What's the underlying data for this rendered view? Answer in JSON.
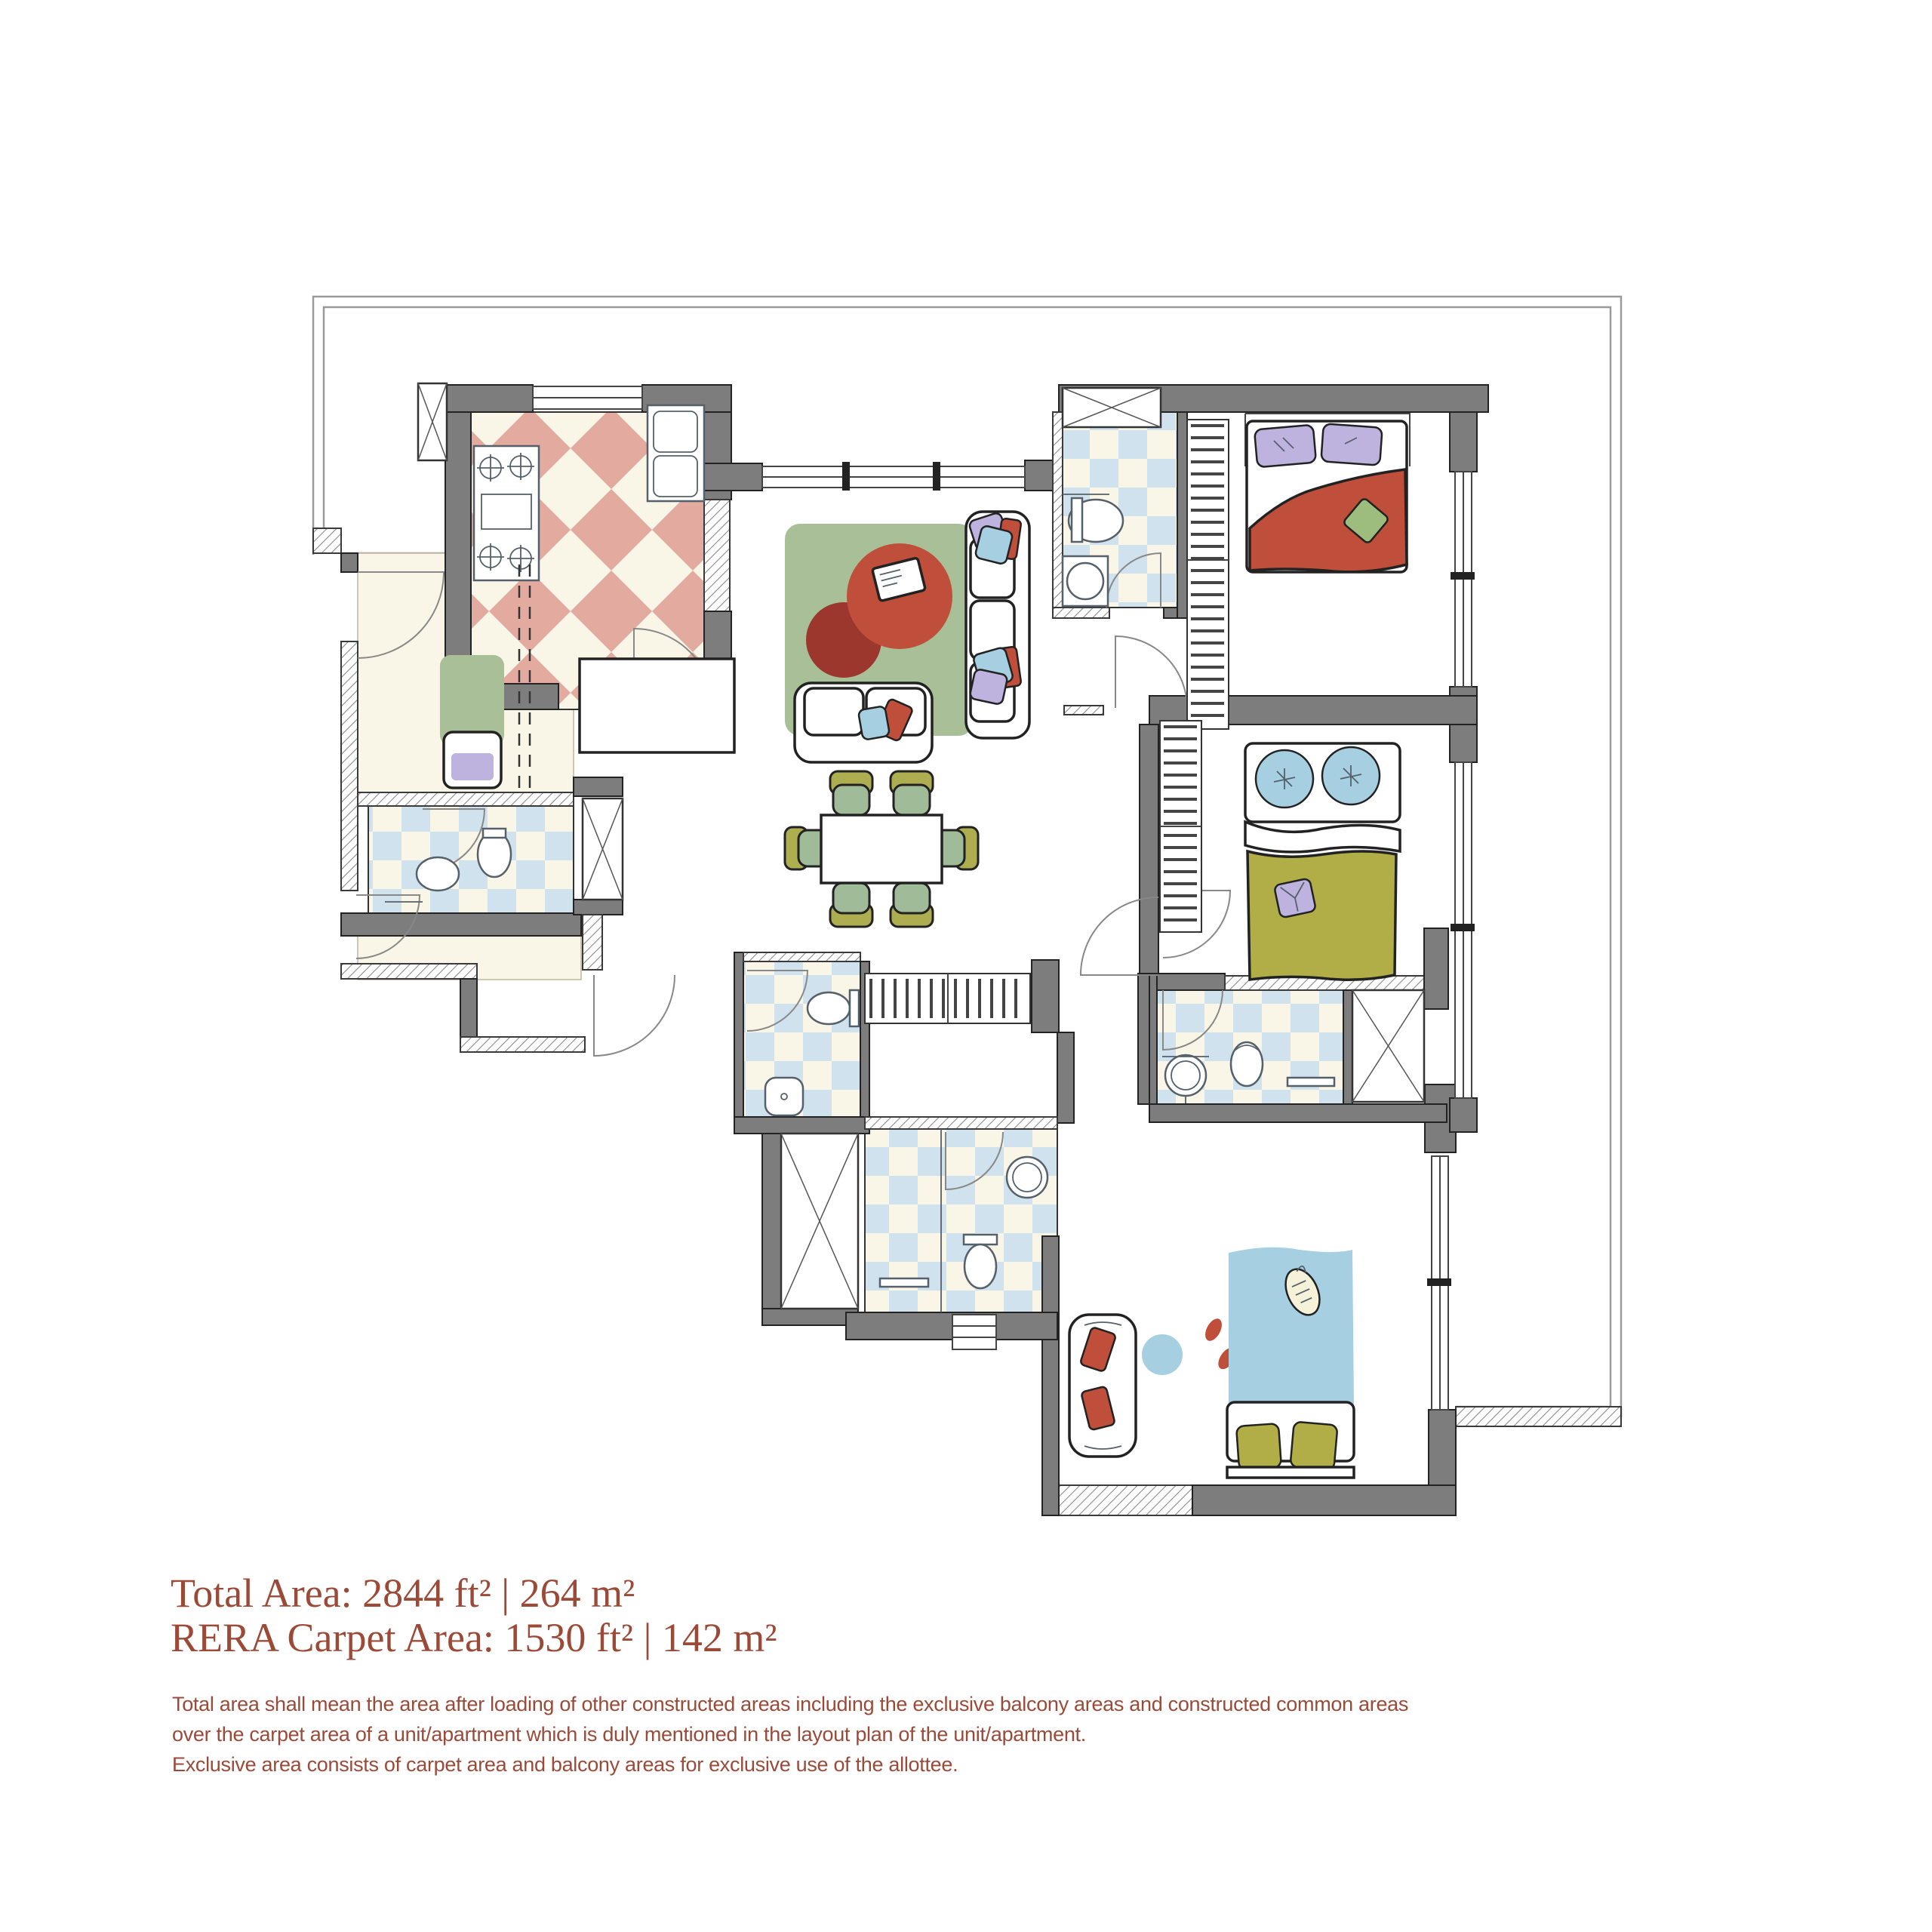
{
  "area_summary": {
    "total_area": "Total Area: 2844 ft² | 264 m²",
    "rera_carpet_area": "RERA Carpet Area: 1530 ft² | 142 m²"
  },
  "disclaimer": {
    "line1": "Total area shall mean the area after loading of other constructed areas including the exclusive balcony areas and constructed common areas",
    "line2": "over the carpet area of a unit/apartment which is duly mentioned in the layout plan of the unit/apartment.",
    "line3": "Exclusive area consists of carpet area and balcony areas for exclusive use of the allottee."
  },
  "colors": {
    "text": "#9c4a38",
    "wall": "#7d7d7d",
    "kitchen_tile": "#e3aa9f",
    "bath_tile": "#cfe2ee",
    "floor_cream": "#faf6e7",
    "rug_green": "#a9bf97",
    "accent_red": "#bf4f3a",
    "accent_red_dark": "#9c372e",
    "accent_olive": "#b1ae48",
    "accent_blue": "#a6cfe1",
    "accent_lavender": "#beb3de",
    "chair_olive": "#aeae50",
    "chair_seat": "#a0bb98"
  }
}
